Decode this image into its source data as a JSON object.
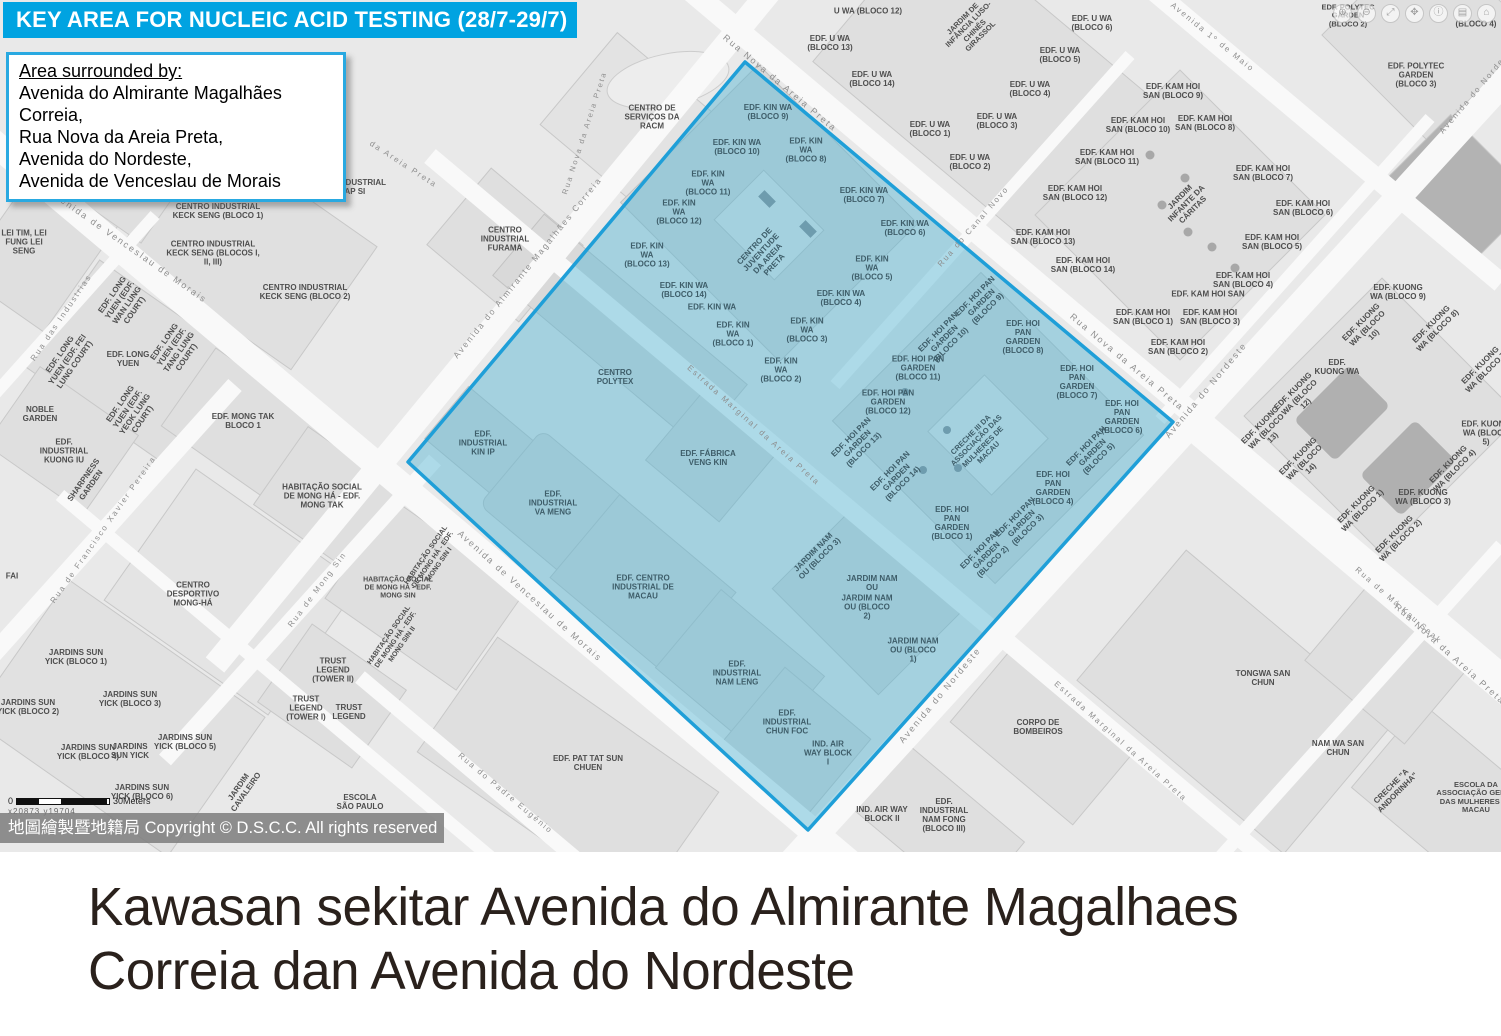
{
  "header": {
    "title": "KEY AREA FOR NUCLEIC ACID TESTING (28/7-29/7)"
  },
  "info_box": {
    "heading": "Area surrounded by:",
    "lines": [
      "Avenida do Almirante Magalhães Correia,",
      "Rua Nova da Areia Preta,",
      "Avenida do Nordeste,",
      "Avenida de Venceslau de Morais"
    ]
  },
  "caption": {
    "line1": "Kawasan sekitar Avenida do Almirante Magalhaes",
    "line2": "Correia dan Avenida do Nordeste"
  },
  "map": {
    "copyright": "地圖繪製暨地籍局 Copyright © D.S.C.C. All rights reserved",
    "scale": {
      "start": "0",
      "end": "30Meters",
      "coords": "x20873  y19704"
    },
    "colors": {
      "header_bg": "#00a3e1",
      "info_border": "#29a9e1",
      "highlight_fill": "#5ab7d5",
      "highlight_border": "#1f9fd8",
      "land": "#e9e9e9",
      "block": "#dfdfdf",
      "road": "#f9f9f9",
      "copyright_bg": "#7d7d7d",
      "caption_text": "#2a211c"
    },
    "controls": [
      {
        "name": "zoom-in",
        "glyph": "⊕"
      },
      {
        "name": "zoom-out",
        "glyph": "⊖"
      },
      {
        "name": "fullscreen",
        "glyph": "⤢"
      },
      {
        "name": "pan-hand",
        "glyph": "✥"
      },
      {
        "name": "info",
        "glyph": "ⓘ"
      },
      {
        "name": "layers",
        "glyph": "▤"
      },
      {
        "name": "home",
        "glyph": "⌂"
      }
    ],
    "labels": [
      {
        "t": "Rua Nova da Areia Preta",
        "x": 780,
        "y": 83,
        "r": 40,
        "c": "road"
      },
      {
        "t": "Rua Nova da Areia Preta",
        "x": 1127,
        "y": 362,
        "r": 40,
        "c": "road"
      },
      {
        "t": "Rua Nova da Areia Preta",
        "x": 1450,
        "y": 654,
        "r": 42,
        "c": "road"
      },
      {
        "t": "Rua Nova da Areia Preta",
        "x": 585,
        "y": 133,
        "r": -72,
        "c": "road",
        "s": 7.5
      },
      {
        "t": "da Areia Preta",
        "x": 403,
        "y": 165,
        "r": 33,
        "c": "road",
        "s": 8
      },
      {
        "t": "Avenida do Almirante Magalhães Correia",
        "x": 528,
        "y": 268,
        "r": -51,
        "c": "road",
        "s": 8.5
      },
      {
        "t": "Avenida de Venceslau de Morais",
        "x": 128,
        "y": 246,
        "r": 35,
        "c": "road"
      },
      {
        "t": "Avenida de Venceslau de Morais",
        "x": 530,
        "y": 596,
        "r": 42,
        "c": "road"
      },
      {
        "t": "Avenida do Nordeste",
        "x": 1478,
        "y": 90,
        "r": -50,
        "c": "road",
        "s": 8
      },
      {
        "t": "Avenida do Nordeste",
        "x": 1206,
        "y": 390,
        "r": -50,
        "c": "road"
      },
      {
        "t": "Avenida do Nordeste",
        "x": 940,
        "y": 695,
        "r": -50,
        "c": "road"
      },
      {
        "t": "Estrada Marginal da Areia Preta",
        "x": 753,
        "y": 426,
        "r": 42,
        "c": "road",
        "s": 8
      },
      {
        "t": "Estrada Marginal da Areia Preta",
        "x": 1120,
        "y": 742,
        "r": 42,
        "c": "road",
        "s": 8
      },
      {
        "t": "Rua do Canal Novo",
        "x": 974,
        "y": 227,
        "r": -49,
        "c": "road",
        "s": 8
      },
      {
        "t": "Rua das Industrias",
        "x": 62,
        "y": 318,
        "r": -56,
        "c": "road",
        "s": 8
      },
      {
        "t": "Rua de Francisco Xavier Pereira",
        "x": 104,
        "y": 530,
        "r": -55,
        "c": "road",
        "s": 8
      },
      {
        "t": "Rua de Mong Sin",
        "x": 318,
        "y": 590,
        "r": -53,
        "c": "road",
        "s": 8
      },
      {
        "t": "Rua de Má Kau Seak",
        "x": 1398,
        "y": 606,
        "r": 41,
        "c": "road",
        "s": 8
      },
      {
        "t": "Avenida 1º de Maio",
        "x": 1212,
        "y": 38,
        "r": 39,
        "c": "road",
        "s": 8
      },
      {
        "t": "Rua do Padre Eugénio",
        "x": 505,
        "y": 794,
        "r": 40,
        "c": "road",
        "s": 8
      },
      {
        "t": "CENTRO DE SERVIÇOS DA RACM",
        "x": 652,
        "y": 118
      },
      {
        "t": "EDF. JARDIM VENCESLAU",
        "x": 112,
        "y": 178
      },
      {
        "t": "EDF. INDUSTRIAL HAP SI",
        "x": 352,
        "y": 188
      },
      {
        "t": "CENTRO INDUSTRIAL KECK SENG (BLOCO 1)",
        "x": 218,
        "y": 212,
        "w": 92
      },
      {
        "t": "CENTRO INDUSTRIAL KECK SENG (BLOCOS I, II, III)",
        "x": 213,
        "y": 254,
        "w": 96
      },
      {
        "t": "CENTRO INDUSTRIAL KECK SENG (BLOCO 2)",
        "x": 305,
        "y": 293,
        "w": 92
      },
      {
        "t": "CENTRO INDUSTRIAL FURAMA",
        "x": 505,
        "y": 240,
        "w": 70
      },
      {
        "t": "LEI TIM, LEI FUNG LEI SENG",
        "x": 24,
        "y": 243,
        "w": 60
      },
      {
        "t": "EDF. LONG YUEN (EDF. WAN LUNG COURT)",
        "x": 124,
        "y": 303,
        "r": -55,
        "w": 64
      },
      {
        "t": "EDF. LONG YUEN (EDF. FEI LUNG COURT)",
        "x": 68,
        "y": 360,
        "r": -55,
        "w": 64
      },
      {
        "t": "EDF. LONG YUEN",
        "x": 128,
        "y": 360,
        "w": 44
      },
      {
        "t": "EDF. LONG YUEN (EDF. TANG LUNG COURT)",
        "x": 176,
        "y": 350,
        "r": -55,
        "w": 64
      },
      {
        "t": "EDF. LONG YUEN (EDF. YEOK LUNG COURT)",
        "x": 132,
        "y": 412,
        "r": -55,
        "w": 64
      },
      {
        "t": "NOBLE GARDEN",
        "x": 40,
        "y": 415,
        "w": 44
      },
      {
        "t": "EDF. MONG TAK BLOCO 1",
        "x": 243,
        "y": 422,
        "w": 64
      },
      {
        "t": "EDF. INDUSTRIAL KUONG IU",
        "x": 64,
        "y": 452,
        "w": 60
      },
      {
        "t": "SHARPNESS GARDEN",
        "x": 88,
        "y": 483,
        "r": -55,
        "w": 60
      },
      {
        "t": "FAI",
        "x": 12,
        "y": 577,
        "w": 30
      },
      {
        "t": "CENTRO DESPORTIVO MONG-HÁ",
        "x": 193,
        "y": 595,
        "w": 78
      },
      {
        "t": "HABITAÇÃO SOCIAL DE MONG HÁ - EDF. MONG TAK",
        "x": 322,
        "y": 497,
        "w": 92
      },
      {
        "t": "HABITAÇÃO SOCIAL DE MONG HÁ - EDF. MONG SIN I",
        "x": 433,
        "y": 560,
        "r": -55,
        "w": 78,
        "s": 7
      },
      {
        "t": "HABITAÇÃO SOCIAL DE MONG HÁ - EDF. MONG SIN",
        "x": 398,
        "y": 588,
        "w": 78,
        "s": 7
      },
      {
        "t": "HABITAÇÃO SOCIAL DE MONG HÁ - EDF. MONG SIN II",
        "x": 396,
        "y": 640,
        "r": -55,
        "w": 78,
        "s": 7
      },
      {
        "t": "JARDINS SUN YICK (BLOCO 1)",
        "x": 76,
        "y": 658
      },
      {
        "t": "JARDINS SUN YICK (BLOCO 2)",
        "x": 28,
        "y": 708
      },
      {
        "t": "JARDINS SUN YICK (BLOCO 3)",
        "x": 130,
        "y": 700
      },
      {
        "t": "JARDINS SUN YICK (BLOCO 4)",
        "x": 88,
        "y": 753
      },
      {
        "t": "JARDINS SUN YICK",
        "x": 130,
        "y": 752,
        "w": 46
      },
      {
        "t": "JARDINS SUN YICK (BLOCO 5)",
        "x": 185,
        "y": 743
      },
      {
        "t": "JARDINS SUN YICK (BLOCO 6)",
        "x": 142,
        "y": 793
      },
      {
        "t": "TRUST LEGEND (TOWER II)",
        "x": 333,
        "y": 671,
        "w": 54
      },
      {
        "t": "TRUST LEGEND (TOWER I)",
        "x": 306,
        "y": 709,
        "w": 54
      },
      {
        "t": "TRUST LEGEND",
        "x": 349,
        "y": 713,
        "w": 44
      },
      {
        "t": "JARDIM CAVALEIRO",
        "x": 243,
        "y": 790,
        "r": -55,
        "w": 56
      },
      {
        "t": "ESCOLA SÃO PAULO",
        "x": 360,
        "y": 803,
        "w": 52
      },
      {
        "t": "EDF. PAT TAT SUN CHUEN",
        "x": 588,
        "y": 764,
        "w": 74
      },
      {
        "t": "CORPO DE BOMBEIROS",
        "x": 1038,
        "y": 728,
        "w": 70
      },
      {
        "t": "TONGWA SAN CHUN",
        "x": 1263,
        "y": 679,
        "w": 60
      },
      {
        "t": "NAM WA SAN CHUN",
        "x": 1338,
        "y": 749,
        "w": 60
      },
      {
        "t": "CRECHE \"A ANDORINHA\"",
        "x": 1395,
        "y": 790,
        "r": -45,
        "w": 62
      },
      {
        "t": "ESCOLA DA ASSOCIAÇÃO GERAL DAS MULHERES DE MACAU",
        "x": 1476,
        "y": 798,
        "w": 84,
        "s": 7.5
      },
      {
        "t": "IND. AIR WAY BLOCK II",
        "x": 882,
        "y": 815,
        "w": 52
      },
      {
        "t": "EDF. INDUSTRIAL NAM FONG (BLOCO III)",
        "x": 944,
        "y": 816,
        "w": 64
      },
      {
        "t": "U WA (BLOCO 12)",
        "x": 868,
        "y": 12,
        "w": 70
      },
      {
        "t": "EDF. U WA (BLOCO 13)",
        "x": 830,
        "y": 44
      },
      {
        "t": "EDF. U WA (BLOCO 14)",
        "x": 872,
        "y": 80
      },
      {
        "t": "JARDIM DE INFÂNCIA LUSO-CHINÊS GIRASSOL",
        "x": 972,
        "y": 28,
        "r": -45,
        "w": 68,
        "s": 7.5
      },
      {
        "t": "EDF. U WA (BLOCO 6)",
        "x": 1092,
        "y": 24,
        "w": 46
      },
      {
        "t": "EDF. U WA (BLOCO 5)",
        "x": 1060,
        "y": 56
      },
      {
        "t": "EDF. U WA (BLOCO 4)",
        "x": 1030,
        "y": 90
      },
      {
        "t": "EDF. U WA (BLOCO 3)",
        "x": 997,
        "y": 122
      },
      {
        "t": "EDF. U WA (BLOCO 1)",
        "x": 930,
        "y": 130,
        "w": 44
      },
      {
        "t": "EDF. U WA (BLOCO 2)",
        "x": 970,
        "y": 163,
        "w": 46
      },
      {
        "t": "EDF. KAM HOI SAN (BLOCO 9)",
        "x": 1173,
        "y": 92
      },
      {
        "t": "EDF. KAM HOI SAN (BLOCO 10)",
        "x": 1138,
        "y": 126
      },
      {
        "t": "EDF. KAM HOI SAN (BLOCO 8)",
        "x": 1205,
        "y": 124
      },
      {
        "t": "EDF. KAM HOI SAN (BLOCO 11)",
        "x": 1107,
        "y": 158
      },
      {
        "t": "EDF. KAM HOI SAN (BLOCO 12)",
        "x": 1075,
        "y": 194
      },
      {
        "t": "EDF. KAM HOI SAN (BLOCO 7)",
        "x": 1263,
        "y": 174
      },
      {
        "t": "EDF. KAM HOI SAN (BLOCO 6)",
        "x": 1303,
        "y": 209
      },
      {
        "t": "EDF. KAM HOI SAN (BLOCO 13)",
        "x": 1043,
        "y": 238
      },
      {
        "t": "JARDIM INFANTE DA CÁRITAS",
        "x": 1187,
        "y": 204,
        "r": -45,
        "w": 66
      },
      {
        "t": "EDF. KAM HOI SAN (BLOCO 5)",
        "x": 1272,
        "y": 243
      },
      {
        "t": "EDF. KAM HOI SAN (BLOCO 14)",
        "x": 1083,
        "y": 266
      },
      {
        "t": "EDF. KAM HOI SAN (BLOCO 4)",
        "x": 1243,
        "y": 281
      },
      {
        "t": "EDF. KAM HOI SAN",
        "x": 1208,
        "y": 295,
        "w": 80
      },
      {
        "t": "EDF. KAM HOI SAN (BLOCO 3)",
        "x": 1210,
        "y": 318
      },
      {
        "t": "EDF. KAM HOI SAN (BLOCO 1)",
        "x": 1143,
        "y": 318
      },
      {
        "t": "EDF. KAM HOI SAN (BLOCO 2)",
        "x": 1178,
        "y": 348
      },
      {
        "t": "EDF. KUONG WA (BLOCO 9)",
        "x": 1398,
        "y": 293,
        "w": 56
      },
      {
        "t": "EDF. KUONG WA (BLOCO 10)",
        "x": 1368,
        "y": 329,
        "r": -45,
        "w": 58
      },
      {
        "t": "EDF. KUONG WA (BLOCO 8)",
        "x": 1435,
        "y": 328,
        "r": -45,
        "w": 58
      },
      {
        "t": "EDF. KUONG WA",
        "x": 1337,
        "y": 368,
        "w": 48
      },
      {
        "t": "EDF. KUONG WA (BLOCO 7)",
        "x": 1484,
        "y": 369,
        "r": -45,
        "w": 58
      },
      {
        "t": "EDF. KUONG WA (BLOCO 12)",
        "x": 1300,
        "y": 398,
        "r": -45,
        "w": 58
      },
      {
        "t": "EDF. KUONG WA (BLOCO 13)",
        "x": 1267,
        "y": 432,
        "r": -45,
        "w": 58
      },
      {
        "t": "EDF. KUONG WA (BLOCO 5)",
        "x": 1486,
        "y": 434,
        "w": 52
      },
      {
        "t": "EDF. KUONG WA (BLOCO 14)",
        "x": 1305,
        "y": 463,
        "r": -45,
        "w": 58
      },
      {
        "t": "EDF. KUONG WA (BLOCO 4)",
        "x": 1452,
        "y": 468,
        "r": -45,
        "w": 58
      },
      {
        "t": "EDF. KUONG WA (BLOCO 3)",
        "x": 1423,
        "y": 498,
        "w": 56
      },
      {
        "t": "EDF. KUONG WA (BLOCO 1)",
        "x": 1360,
        "y": 508,
        "r": -45,
        "w": 58
      },
      {
        "t": "EDF. KUONG WA (BLOCO 2)",
        "x": 1398,
        "y": 538,
        "r": -45,
        "w": 58
      },
      {
        "t": "EDF. POLYTEC GARDEN (BLOCO 2)",
        "x": 1348,
        "y": 16,
        "w": 60,
        "s": 7.5
      },
      {
        "t": "(BLOCO 4)",
        "x": 1476,
        "y": 25,
        "w": 50
      },
      {
        "t": "EDF. POLYTEC GARDEN (BLOCO 3)",
        "x": 1416,
        "y": 76,
        "w": 60
      },
      {
        "t": "EDF. KIN WA (BLOCO 9)",
        "x": 768,
        "y": 113,
        "c": "area"
      },
      {
        "t": "EDF. KIN WA (BLOCO 10)",
        "x": 737,
        "y": 148,
        "c": "area"
      },
      {
        "t": "EDF. KIN WA (BLOCO 8)",
        "x": 806,
        "y": 151,
        "c": "area",
        "w": 46
      },
      {
        "t": "EDF. KIN WA (BLOCO 11)",
        "x": 708,
        "y": 184,
        "c": "area",
        "w": 46
      },
      {
        "t": "EDF. KIN WA (BLOCO 7)",
        "x": 864,
        "y": 196,
        "c": "area"
      },
      {
        "t": "EDF. KIN WA (BLOCO 12)",
        "x": 679,
        "y": 213,
        "c": "area",
        "w": 46
      },
      {
        "t": "EDF. KIN WA (BLOCO 6)",
        "x": 905,
        "y": 229,
        "c": "area"
      },
      {
        "t": "EDF. KIN WA (BLOCO 13)",
        "x": 647,
        "y": 256,
        "c": "area",
        "w": 46
      },
      {
        "t": "CENTRO DE JUVENTUDE DA AREIA PRETA",
        "x": 765,
        "y": 256,
        "r": -47,
        "c": "area",
        "w": 62
      },
      {
        "t": "EDF. KIN WA (BLOCO 5)",
        "x": 872,
        "y": 269,
        "c": "area",
        "w": 46
      },
      {
        "t": "EDF. KIN WA (BLOCO 14)",
        "x": 684,
        "y": 291,
        "c": "area"
      },
      {
        "t": "EDF. KIN WA (BLOCO 4)",
        "x": 841,
        "y": 299,
        "c": "area"
      },
      {
        "t": "EDF. KIN WA",
        "x": 712,
        "y": 308,
        "c": "area",
        "w": 60
      },
      {
        "t": "EDF. KIN WA (BLOCO 1)",
        "x": 733,
        "y": 335,
        "c": "area",
        "w": 46
      },
      {
        "t": "EDF. KIN WA (BLOCO 3)",
        "x": 807,
        "y": 331,
        "c": "area",
        "w": 46
      },
      {
        "t": "EDF. KIN WA (BLOCO 2)",
        "x": 781,
        "y": 371,
        "c": "area",
        "w": 46
      },
      {
        "t": "CENTRO POLYTEX",
        "x": 615,
        "y": 378,
        "c": "area",
        "w": 52
      },
      {
        "t": "EDF. INDUSTRIAL KIN IP",
        "x": 483,
        "y": 444,
        "c": "area",
        "w": 58
      },
      {
        "t": "EDF. FÁBRICA VENG KIN",
        "x": 708,
        "y": 459,
        "c": "area",
        "w": 64
      },
      {
        "t": "EDF. INDUSTRIAL VA MENG",
        "x": 553,
        "y": 504,
        "c": "area",
        "w": 58
      },
      {
        "t": "EDF. CENTRO INDUSTRIAL DE MACAU",
        "x": 643,
        "y": 588,
        "c": "area",
        "w": 66
      },
      {
        "t": "EDF. INDUSTRIAL NAM LENG",
        "x": 737,
        "y": 674,
        "c": "area",
        "w": 62
      },
      {
        "t": "EDF. INDUSTRIAL CHUN FOC",
        "x": 787,
        "y": 723,
        "c": "area",
        "w": 58
      },
      {
        "t": "IND. AIR WAY BLOCK I",
        "x": 828,
        "y": 754,
        "c": "area",
        "w": 48
      },
      {
        "t": "EDF. HOI PAN GARDEN (BLOCO 9)",
        "x": 982,
        "y": 303,
        "r": -45,
        "c": "area",
        "w": 56
      },
      {
        "t": "EDF. HOI PAN GARDEN (BLOCO 10)",
        "x": 945,
        "y": 339,
        "r": -45,
        "c": "area",
        "w": 56
      },
      {
        "t": "EDF. HOI PAN GARDEN (BLOCO 8)",
        "x": 1023,
        "y": 338,
        "c": "area",
        "w": 52
      },
      {
        "t": "EDF. HOI PAN GARDEN (BLOCO 11)",
        "x": 918,
        "y": 369,
        "c": "area",
        "w": 56
      },
      {
        "t": "EDF. HOI PAN GARDEN (BLOCO 7)",
        "x": 1077,
        "y": 383,
        "c": "area",
        "w": 52
      },
      {
        "t": "EDF. HOI PAN GARDEN (BLOCO 12)",
        "x": 888,
        "y": 403,
        "c": "area",
        "w": 56
      },
      {
        "t": "EDF. HOI PAN GARDEN (BLOCO 6)",
        "x": 1122,
        "y": 418,
        "c": "area",
        "w": 52
      },
      {
        "t": "EDF. HOI PAN GARDEN (BLOCO 13)",
        "x": 858,
        "y": 444,
        "r": -45,
        "c": "area",
        "w": 56
      },
      {
        "t": "CRECHE III DA ASSOCIAÇÃO DAS MULHERES DE MACAU",
        "x": 980,
        "y": 444,
        "r": -45,
        "c": "area",
        "w": 72,
        "s": 7.5
      },
      {
        "t": "EDF. HOI PAN GARDEN (BLOCO 5)",
        "x": 1093,
        "y": 453,
        "r": -45,
        "c": "area",
        "w": 56
      },
      {
        "t": "EDF. HOI PAN GARDEN (BLOCO 14)",
        "x": 897,
        "y": 478,
        "r": -45,
        "c": "area",
        "w": 56
      },
      {
        "t": "EDF. HOI PAN GARDEN (BLOCO 4)",
        "x": 1053,
        "y": 489,
        "c": "area",
        "w": 52
      },
      {
        "t": "EDF. HOI PAN GARDEN (BLOCO 1)",
        "x": 952,
        "y": 524,
        "c": "area",
        "w": 52
      },
      {
        "t": "EDF. HOI PAN GARDEN (BLOCO 3)",
        "x": 1022,
        "y": 524,
        "r": -45,
        "c": "area",
        "w": 56
      },
      {
        "t": "EDF. HOI PAN GARDEN (BLOCO 2)",
        "x": 987,
        "y": 556,
        "r": -45,
        "c": "area",
        "w": 56
      },
      {
        "t": "JARDIM NAM OU (BLOCO 3)",
        "x": 817,
        "y": 556,
        "r": -45,
        "c": "area",
        "w": 56
      },
      {
        "t": "JARDIM NAM OU",
        "x": 872,
        "y": 584,
        "c": "area",
        "w": 52
      },
      {
        "t": "JARDIM NAM OU (BLOCO 2)",
        "x": 867,
        "y": 608,
        "c": "area",
        "w": 52
      },
      {
        "t": "JARDIM NAM OU (BLOCO 1)",
        "x": 913,
        "y": 651,
        "c": "area",
        "w": 52
      }
    ]
  }
}
